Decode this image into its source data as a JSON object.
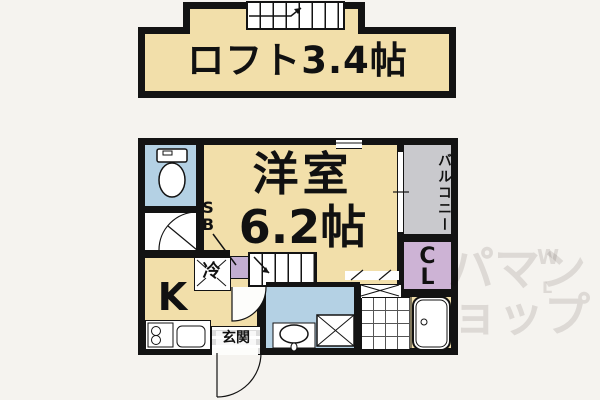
{
  "colors": {
    "wall": "#131313",
    "room_cream": "#f2dfaa",
    "water_blue": "#b4d1e4",
    "closet_purple": "#cdb3d5",
    "shoebox_purple": "#c3aed1",
    "balcony_gray": "#c9c9cd",
    "background": "#f5f3ef",
    "watermark": "#e6e4e4"
  },
  "loft": {
    "label": "ロフト3.4帖"
  },
  "rooms": {
    "main": {
      "name": "洋室",
      "size": "6.2帖"
    },
    "kitchen": {
      "label": "K"
    },
    "balcony": {
      "label": "バルコニー"
    },
    "closet": {
      "line1": "C",
      "line2": "L"
    },
    "shoebox": {
      "line1": "S",
      "line2": "B"
    },
    "fridge": {
      "label": "冷"
    },
    "entrance": {
      "label": "玄関"
    }
  },
  "watermark": {
    "line1": "パマン",
    "line2": "ョップ",
    "sup": "W",
    "sub": "L"
  }
}
